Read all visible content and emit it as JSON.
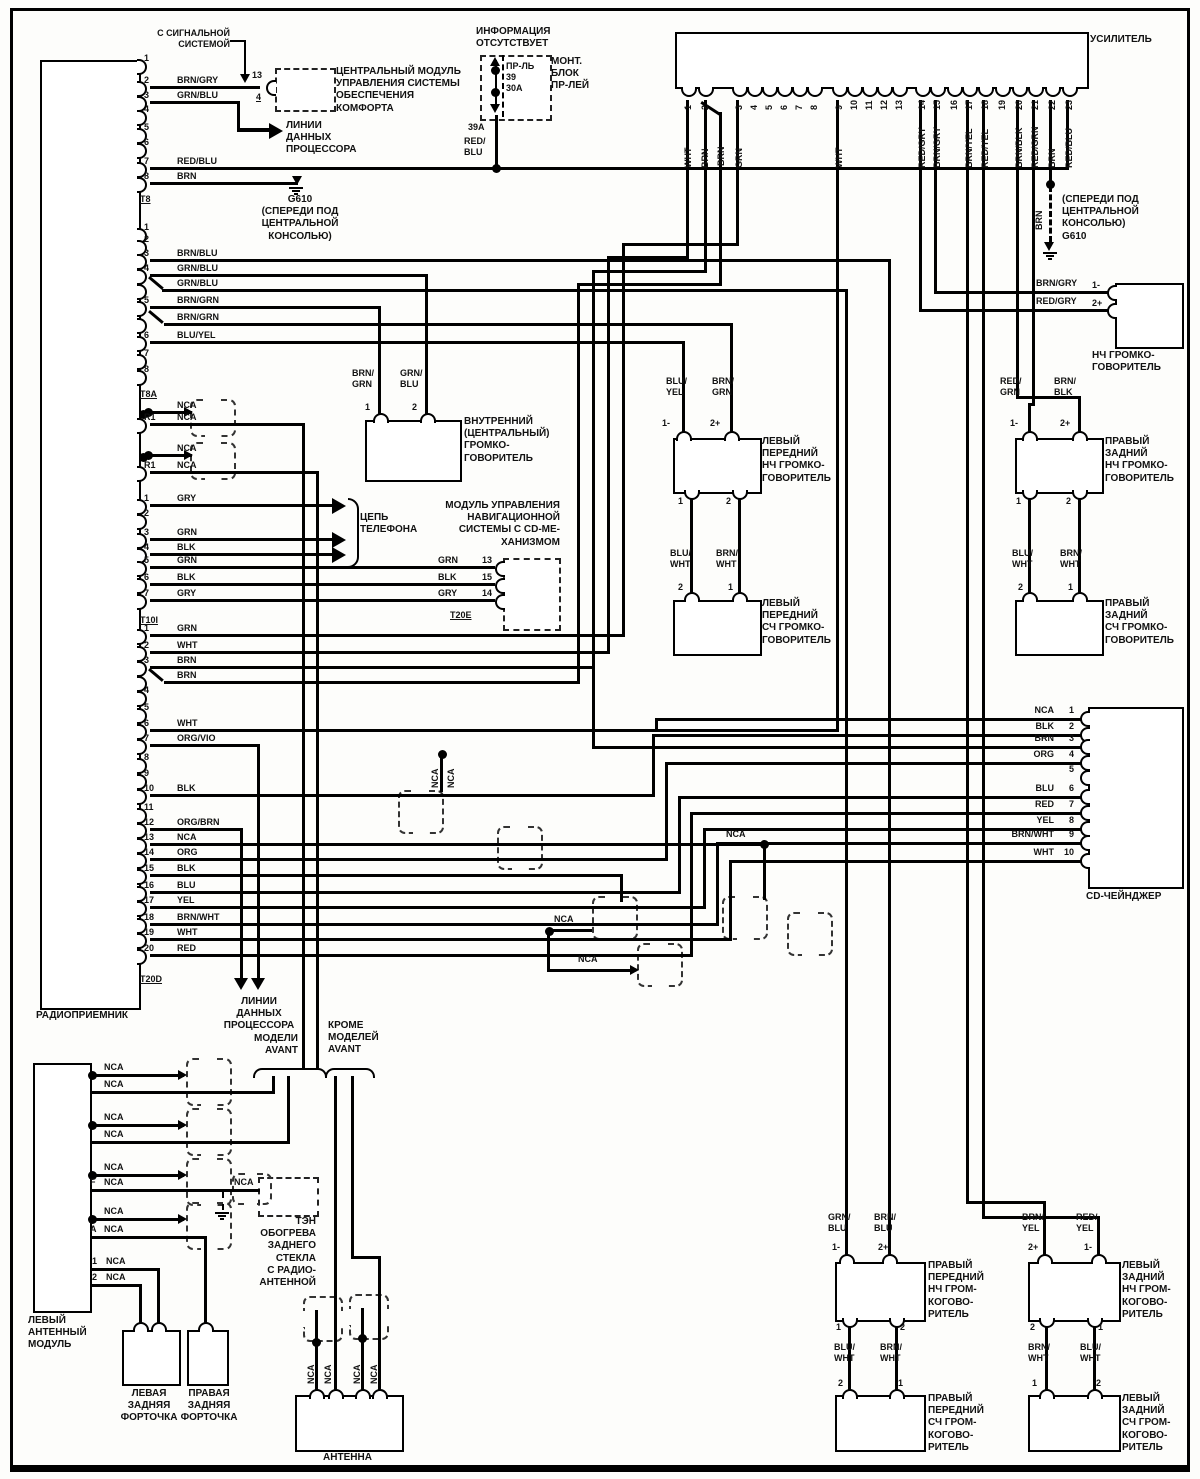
{
  "t": {
    "signal": "С СИГНАЛЬНОЙ\nСИСТЕМОЙ",
    "comfort": "ЦЕНТРАЛЬНЫЙ МОДУЛЬ\nУПРАВЛЕНИЯ СИСТЕМЫ\nОБЕСПЕЧЕНИЯ\nКОМФОРТА",
    "data_lines": "ЛИНИИ\nДАННЫХ\nПРОЦЕССОРА",
    "no_info": "ИНФОРМАЦИЯ\nОТСУТСТВУЕТ",
    "fuse": "ПР-ЛЬ\n39\n30А",
    "fuse_block": "МОНТ.\nБЛОК\nПР-ЛЕЙ",
    "g610_left": "G610\n(СПЕРЕДИ ПОД\nЦЕНТРАЛЬНОЙ\nКОНСОЛЬЮ)",
    "g610_right": "(СПЕРЕДИ ПОД\nЦЕНТРАЛЬНОЙ\nКОНСОЛЬЮ)\nG610",
    "woofer_right": "НЧ ГРОМКО-\nГОВОРИТЕЛЬ",
    "center_spk": "ВНУТРЕННИЙ\n(ЦЕНТРАЛЬНЫЙ)\nГРОМКО-\nГОВОРИТЕЛЬ",
    "phone": "ЦЕПЬ\nТЕЛЕФОНА",
    "nav": "МОДУЛЬ УПРАВЛЕНИЯ\nНАВИГАЦИОННОЙ\nСИСТЕМЫ С CD-МЕ-\nХАНИЗМОМ",
    "t20e": "T20E",
    "front_left_w": "ЛЕВЫЙ\nПЕРЕДНИЙ\nНЧ ГРОМКО-\nГОВОРИТЕЛЬ",
    "front_left_m": "ЛЕВЫЙ\nПЕРЕДНИЙ\nСЧ ГРОМКО-\nГОВОРИТЕЛЬ",
    "rear_right_w": "ПРАВЫЙ\nЗАДНИЙ\nНЧ ГРОМКО-\nГОВОРИТЕЛЬ",
    "rear_right_m": "ПРАВЫЙ\nЗАДНИЙ\nСЧ ГРОМКО-\nГОВОРИТЕЛЬ",
    "avant": "МОДЕЛИ\nAVANT",
    "not_avant": "КРОМЕ\nМОДЕЛЕЙ\nAVANT",
    "ant_module": "ЛЕВЫЙ\nАНТЕННЫЙ\nМОДУЛЬ",
    "defogger": "ТЭН\nОБОГРЕВА\nЗАДНЕГО\nСТЕКЛА\nС РАДИО-\nАНТЕННОЙ",
    "left_vent": "ЛЕВАЯ\nЗАДНЯЯ\nФОРТОЧКА",
    "right_vent": "ПРАВАЯ\nЗАДНЯЯ\nФОРТОЧКА",
    "antenna": "АНТЕННА",
    "front_right_w": "ПРАВЫЙ\nПЕРЕДНИЙ\nНЧ ГРОМ-\nКОГОВО-\nРИТЕЛЬ",
    "front_right_m": "ПРАВЫЙ\nПЕРЕДНИЙ\nСЧ ГРОМ-\nКОГОВО-\nРИТЕЛЬ",
    "rear_left_w": "ЛЕВЫЙ\nЗАДНИЙ\nНЧ ГРОМ-\nКОГОВО-\nРИТЕЛЬ",
    "rear_left_m": "ЛЕВЫЙ\nЗАДНИЙ\nСЧ ГРОМ-\nКОГОВО-\nРИТЕЛЬ"
  },
  "w": {
    "nca": "NCA",
    "brn": "BRN",
    "brn_gry": "BRN/GRY",
    "red_gry": "RED/GRY",
    "red_blu2": "RED/\nBLU",
    "grn_blu2": "GRN/\nBLU",
    "brn_grn2": "BRN/\nGRN",
    "blu_yel2": "BLU/\nYEL",
    "blu_wht2": "BLU/\nWHT",
    "brn_wht2": "BRN/\nWHT",
    "red_grn2": "RED/\nGRN",
    "brn_blk2": "BRN/\nBLK",
    "brn_blu2": "BRN/\nBLU",
    "brn_yel2": "BRN/\nYEL",
    "red_yel2": "RED/\nYEL"
  },
  "n": {
    "p1": "1",
    "p2": "2",
    "p4": "4",
    "p13": "13",
    "p39a": "39А",
    "p1m": "1-",
    "p2p": "2+"
  },
  "radio": {
    "name": "РАДИОПРИЕМНИК",
    "groups": [
      {
        "label": "T8",
        "rows": [
          {
            "pin": "1"
          },
          {
            "pin": "2",
            "color": "BRN/GRY"
          },
          {
            "pin": "3",
            "color": "GRN/BLU"
          },
          {
            "pin": "4"
          },
          {
            "pin": "5"
          },
          {
            "pin": "6"
          },
          {
            "pin": "7",
            "color": "RED/BLU"
          },
          {
            "pin": "8",
            "color": "BRN"
          }
        ]
      },
      {
        "label": "T8A",
        "rows": [
          {
            "pin": "1"
          },
          {
            "pin": "2"
          },
          {
            "pin": "3",
            "color": "BRN/BLU"
          },
          {
            "pin": "4",
            "color": "GRN/BLU"
          },
          {
            "color": "GRN/BLU"
          },
          {
            "pin": "5",
            "color": "BRN/GRN"
          },
          {
            "color": "BRN/GRN"
          },
          {
            "pin": "6",
            "color": "BLU/YEL"
          },
          {
            "pin": "7"
          },
          {
            "pin": "8"
          }
        ]
      },
      {
        "label": "",
        "rows": [
          {
            "color": "NCA",
            "dot": true
          },
          {
            "pin": "R1",
            "color": "NCA"
          },
          {
            "color": "NCA",
            "dot": true
          },
          {
            "pin": "R1",
            "color": "NCA"
          }
        ]
      },
      {
        "label": "T10I",
        "rows": [
          {
            "pin": "1",
            "color": "GRY"
          },
          {
            "pin": "2"
          },
          {
            "pin": "3",
            "color": "GRN"
          },
          {
            "pin": "4",
            "color": "BLK"
          },
          {
            "pin": "5",
            "color": "GRN"
          },
          {
            "pin": "6",
            "color": "BLK"
          },
          {
            "pin": "7",
            "color": "GRY"
          }
        ]
      },
      {
        "label": "T20D",
        "rows": [
          {
            "pin": "1",
            "color": "GRN"
          },
          {
            "pin": "2",
            "color": "WHT"
          },
          {
            "pin": "3",
            "color": "BRN"
          },
          {
            "color": "BRN"
          },
          {
            "pin": "4"
          },
          {
            "pin": "5"
          },
          {
            "pin": "6",
            "color": "WHT"
          },
          {
            "pin": "7",
            "color": "ORG/VIO"
          },
          {
            "pin": "8"
          },
          {
            "pin": "9"
          },
          {
            "pin": "10",
            "color": "BLK"
          },
          {
            "pin": "11"
          },
          {
            "pin": "12",
            "color": "ORG/BRN"
          },
          {
            "pin": "13",
            "color": "NCA"
          },
          {
            "pin": "14",
            "color": "ORG"
          },
          {
            "pin": "15",
            "color": "BLK"
          },
          {
            "pin": "16",
            "color": "BLU"
          },
          {
            "pin": "17",
            "color": "YEL"
          },
          {
            "pin": "18",
            "color": "BRN/WHT"
          },
          {
            "pin": "19",
            "color": "WHT"
          },
          {
            "pin": "20",
            "color": "RED"
          }
        ]
      }
    ]
  },
  "amp": {
    "name": "УСИЛИТЕЛЬ",
    "pins": [
      {
        "n": "1",
        "color": "WHT"
      },
      {
        "n": "2",
        "color": "BRN"
      },
      {
        "n": "3",
        "color": "GRN"
      },
      {
        "n": "4"
      },
      {
        "n": "5"
      },
      {
        "n": "6"
      },
      {
        "n": "7"
      },
      {
        "n": "8"
      },
      {
        "n": "9",
        "color": "WHT"
      },
      {
        "n": "10"
      },
      {
        "n": "11"
      },
      {
        "n": "12"
      },
      {
        "n": "13"
      },
      {
        "n": "14",
        "color": "RED/GRY"
      },
      {
        "n": "15",
        "color": "BRN/GRY"
      },
      {
        "n": "16"
      },
      {
        "n": "17",
        "color": "BRN/YEL"
      },
      {
        "n": "18",
        "color": "RED/YEL"
      },
      {
        "n": "19"
      },
      {
        "n": "20",
        "color": "BRN/BLK"
      },
      {
        "n": "21",
        "color": "RED/GRN"
      },
      {
        "n": "22",
        "color": "BRN"
      },
      {
        "n": "23",
        "color": "RED/BLU"
      }
    ]
  },
  "cd": {
    "name": "CD-ЧЕЙНДЖЕР",
    "pins": [
      {
        "n": "1",
        "color": "NCA"
      },
      {
        "n": "2",
        "color": "BLK"
      },
      {
        "n": "3",
        "color": "BRN"
      },
      {
        "n": "4",
        "color": "ORG"
      },
      {
        "n": "5"
      },
      {
        "n": "6",
        "color": "BLU"
      },
      {
        "n": "7",
        "color": "RED"
      },
      {
        "n": "8",
        "color": "YEL"
      },
      {
        "n": "9",
        "color": "BRN/WHT"
      },
      {
        "n": "10",
        "color": "WHT"
      }
    ]
  },
  "nav": {
    "pins": [
      {
        "n": "13",
        "color": "GRN"
      },
      {
        "n": "15",
        "color": "BLK"
      },
      {
        "n": "14",
        "color": "GRY"
      }
    ]
  }
}
